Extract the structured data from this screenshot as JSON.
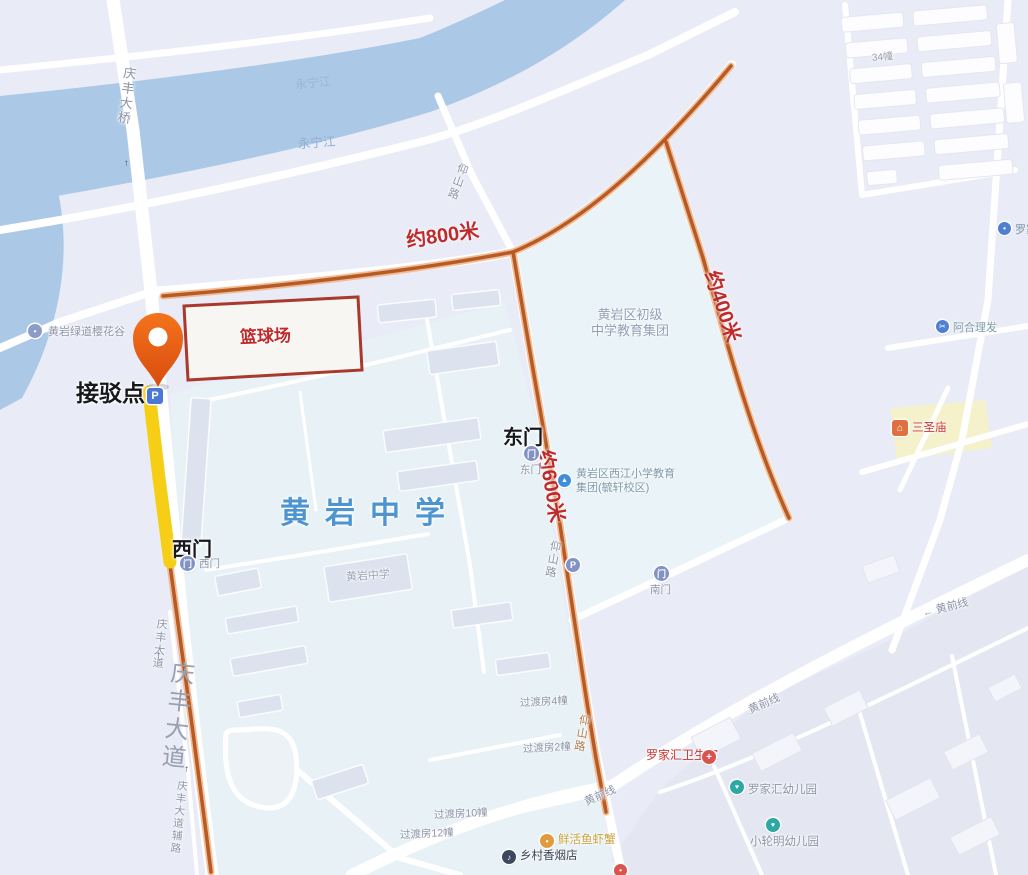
{
  "colors": {
    "route_orange": "#b65a26",
    "route_halo": "#f0b183",
    "highlight_yellow": "#f7ce16",
    "distance_red": "#bf2b2b",
    "school_blue": "#4e95d0",
    "river_blue": "#abc9e6",
    "pin_orange": "#ee5a13",
    "court_red": "#a9392c"
  },
  "icons": {
    "parking": "P",
    "gate": "门",
    "arrow_up": "↑",
    "arrow_left": "←",
    "dot": "•",
    "heart": "♥",
    "plus": "+",
    "house": "⌂",
    "note": "♪",
    "scissors": "✂",
    "cap": "▲"
  },
  "marker": {
    "label": "接驳点"
  },
  "routes": {
    "d800": "约800米",
    "d600": "约600米",
    "d400": "约400米"
  },
  "places": {
    "school_title": "黄岩中学",
    "school_building": "黄岩中学",
    "junior_l1": "黄岩区初级",
    "junior_l2": "中学教育集团",
    "xijiang_l1": "黄岩区西江小学教育",
    "xijiang_l2": "集团(毓轩校区)",
    "basketball": "篮球场",
    "greenway": "黄岩绿道樱花谷",
    "health": "罗家汇卫生室",
    "kindergarten1": "罗家汇幼儿园",
    "kindergarten2": "小轮明幼儿园",
    "temple": "三圣庙",
    "barber": "阿合理发",
    "fish_shop": "鲜活鱼虾蟹",
    "tobacco_shop": "乡村香烟店",
    "poi_cut": "罗家",
    "block34": "34幢"
  },
  "gates": {
    "east": "东门",
    "west": "西门",
    "south": "南门",
    "east_small": "东门",
    "west_small": "西门"
  },
  "roads": {
    "qingfeng_bridge": "庆丰大桥",
    "qingfeng_ave": "庆丰大道",
    "qingfeng_service": "庆丰大道辅路",
    "yangshan": "仰山路",
    "huangqian": "黄前线",
    "river": "永宁江"
  },
  "housing": {
    "g4": "过渡房4幢",
    "g2": "过渡房2幢",
    "g10": "过渡房10幢",
    "g12": "过渡房12幢"
  }
}
